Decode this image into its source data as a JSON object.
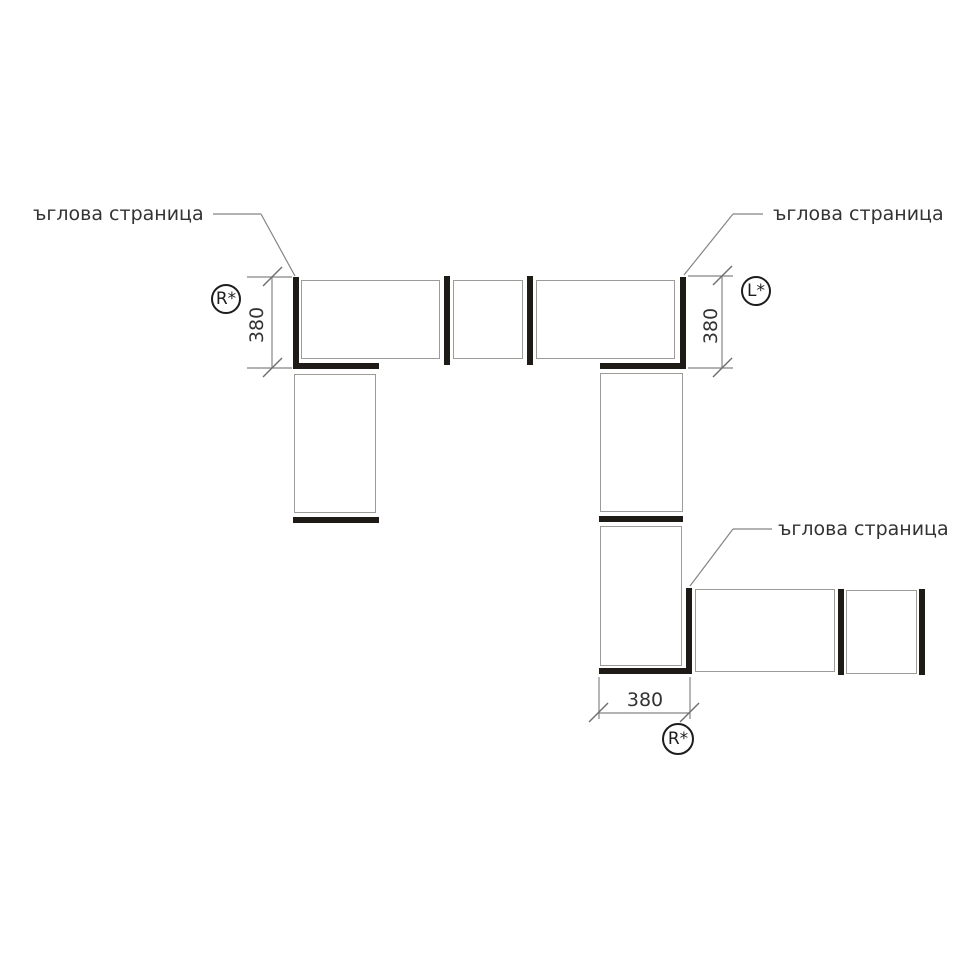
{
  "diagram": {
    "labels": {
      "top_left": "ъглова страница",
      "top_right": "ъглова страница",
      "bottom": "ъглова страница"
    },
    "dimensions": {
      "left_vertical": "380",
      "right_vertical": "380",
      "bottom_horizontal": "380"
    },
    "markers": {
      "top_left": "R*",
      "top_right": "L*",
      "bottom": "R*"
    },
    "colors": {
      "panel_bar": "#1e1a16",
      "panel_outline": "#9d9b98",
      "thin_line": "#858585",
      "text": "#333333",
      "background": "#ffffff"
    }
  }
}
